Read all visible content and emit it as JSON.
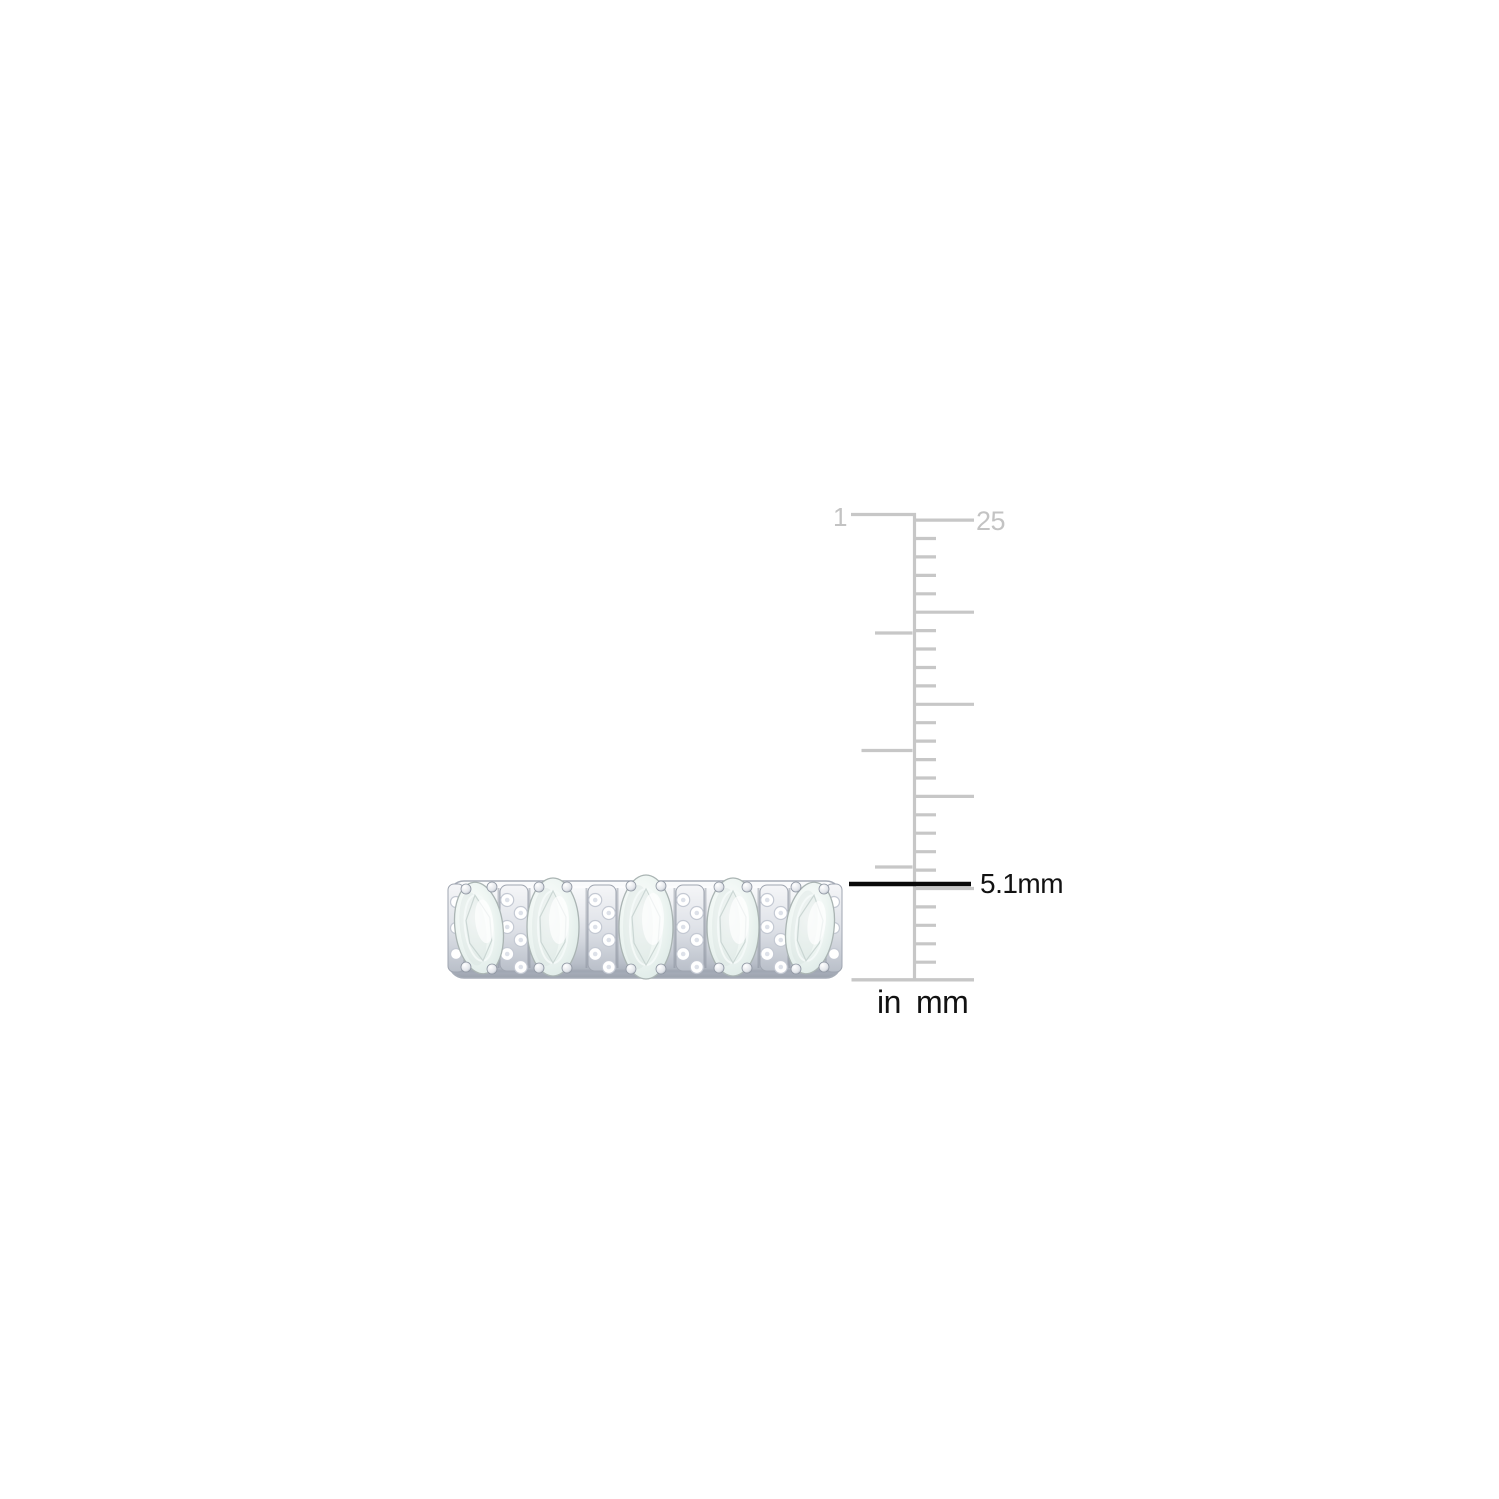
{
  "image": {
    "type": "product-photo",
    "background": "#ffffff",
    "subject": "Five-stone oval aquamarine and diamond band ring photographed beside a vertical inch/millimeter ruler with band-width measurement"
  },
  "ring": {
    "oval_stone_count": 5,
    "pave_spacer_count": 4,
    "stone_color": "#e9f2ef",
    "metal_color": "#c9cdd4"
  },
  "ruler": {
    "orientation": "vertical",
    "inch_label_top": "1",
    "mm_label_top": "25",
    "unit_label_inch": "in",
    "unit_label_mm": "mm",
    "scale": {
      "mm_total": 25,
      "long_tick_every_mm": 5,
      "inch_divisions": 4
    },
    "colors": {
      "ruler_line": "#c7c7c7",
      "ruler_label": "#c3c3c3",
      "unit_text": "#121212"
    }
  },
  "measurement": {
    "label": "5.1mm",
    "line_color": "#0a0a0a",
    "text_color": "#121212"
  }
}
